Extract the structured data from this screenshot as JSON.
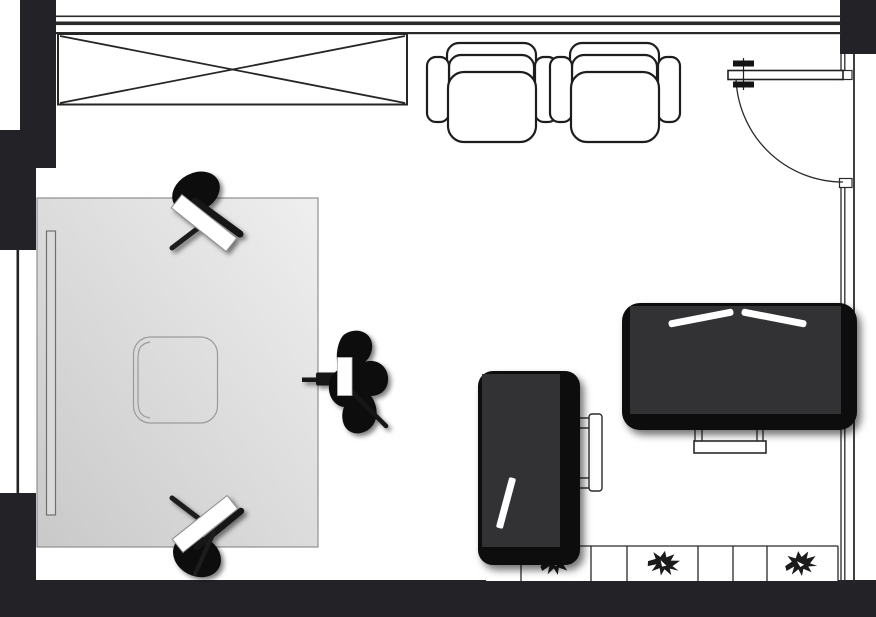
{
  "app": {
    "view_label": "room-floor-plan",
    "canvas": {
      "width": 876,
      "height": 617
    }
  },
  "palette": {
    "wall": "#232327",
    "outline": "#2a2a2a",
    "furniture_outline": "#1d1d1d",
    "furniture_shadow": "#0a0a0a",
    "furniture_body": "#323234",
    "table_gradient_dark": "#c9c9c9",
    "table_gradient_light": "#efefef",
    "panel_fill": "#d9d9d9",
    "white": "#ffffff",
    "plant": "#1b1b1b",
    "chair_black": "#0d0d0d"
  },
  "room": {
    "walls": [
      {
        "id": "wall-top-left-block",
        "side": "top-left"
      },
      {
        "id": "wall-left-upper",
        "side": "left"
      },
      {
        "id": "wall-left-lower",
        "side": "left"
      },
      {
        "id": "wall-bottom",
        "side": "bottom"
      },
      {
        "id": "wall-top-right-block",
        "side": "top-right"
      },
      {
        "id": "wall-top-lines",
        "side": "top"
      },
      {
        "id": "wall-right-lines",
        "side": "right"
      }
    ],
    "openings": [
      {
        "id": "window-left",
        "kind": "window",
        "wall": "left"
      },
      {
        "id": "door-top-right",
        "kind": "door",
        "wall": "right",
        "swing": "inward"
      }
    ]
  },
  "furniture": [
    {
      "id": "wardrobe",
      "kind": "crossed-box"
    },
    {
      "id": "armchair-1",
      "kind": "armchair"
    },
    {
      "id": "armchair-2",
      "kind": "armchair"
    },
    {
      "id": "desk-table",
      "kind": "large-table"
    },
    {
      "id": "wall-panel",
      "kind": "narrow-panel"
    },
    {
      "id": "under-desk-chair-outline",
      "kind": "chair-outline"
    },
    {
      "id": "side-chair-top",
      "kind": "angled-chair"
    },
    {
      "id": "side-chair-bottom",
      "kind": "angled-chair"
    },
    {
      "id": "office-chair",
      "kind": "swivel-chair"
    },
    {
      "id": "tucked-chair",
      "kind": "chair-outline"
    },
    {
      "id": "cabinet",
      "kind": "dark-cabinet"
    },
    {
      "id": "bed",
      "kind": "dark-bed"
    },
    {
      "id": "bed-bench",
      "kind": "bench"
    },
    {
      "id": "plant-shelf",
      "kind": "tiled-shelf",
      "tile_dividers_x": [
        521,
        591,
        627,
        698,
        733,
        767
      ]
    },
    {
      "id": "plant-1",
      "kind": "plant"
    },
    {
      "id": "plant-2",
      "kind": "plant"
    },
    {
      "id": "plant-3",
      "kind": "plant"
    }
  ]
}
